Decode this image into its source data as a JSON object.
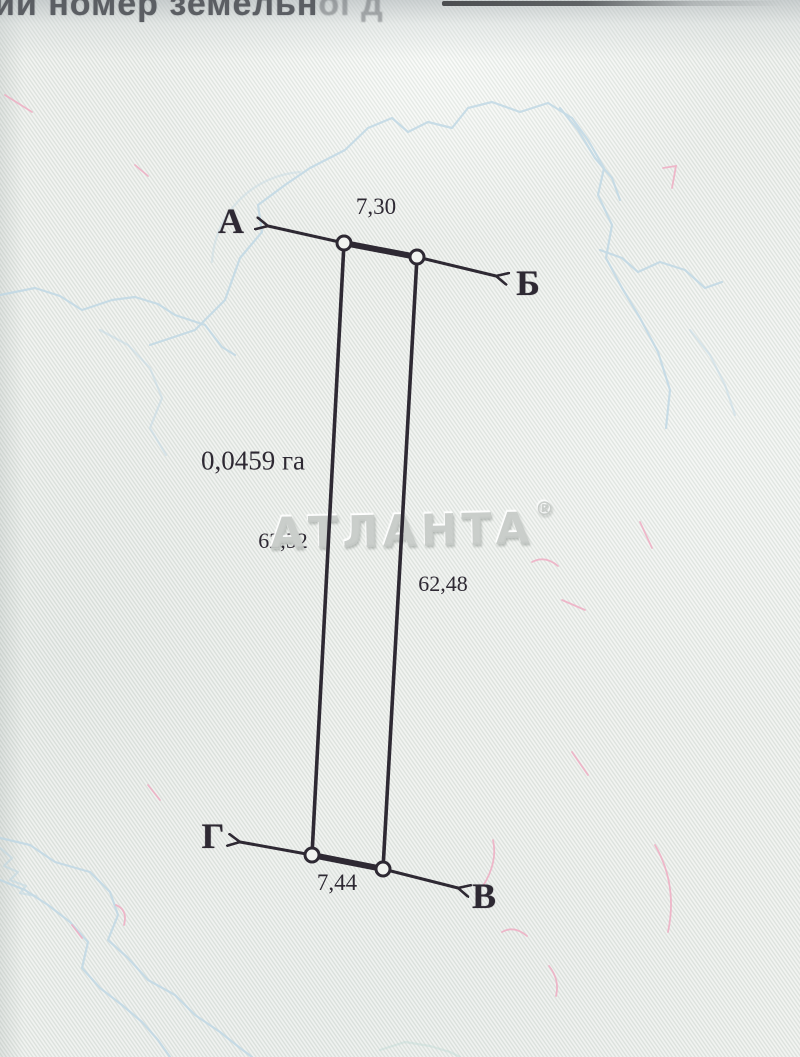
{
  "header": {
    "fragment_strong": "ий номер земельн",
    "fragment_faded": "ої д"
  },
  "watermark": {
    "text": "АТЛАНТА",
    "registered": "®"
  },
  "diagram": {
    "type": "land-parcel-plan",
    "labels": {
      "point_a": "А",
      "point_b": "Б",
      "point_v": "В",
      "point_g": "Г",
      "len_top": "7,30",
      "len_left": "62,52",
      "len_right": "62,48",
      "len_bottom": "7,44",
      "area": "0,0459 га"
    },
    "sides": [
      {
        "from": "А",
        "to": "Б",
        "edge": "top",
        "length_m": "7,30"
      },
      {
        "from": "Б",
        "to": "В",
        "edge": "right",
        "length_m": "62,48"
      },
      {
        "from": "Г",
        "to": "В",
        "edge": "bottom",
        "length_m": "7,44"
      },
      {
        "from": "А",
        "to": "Г",
        "edge": "left",
        "length_m": "62,52"
      }
    ],
    "area_value": "0,0459",
    "area_unit": "га"
  },
  "colors": {
    "paper": "#e9ece8",
    "ink": "#2e2933",
    "contour_blue": "#bcd6e4",
    "fiber_pink": "#efa9c1",
    "watermark_gray": "#c6cbc8",
    "header_text": "#5b5e63"
  }
}
